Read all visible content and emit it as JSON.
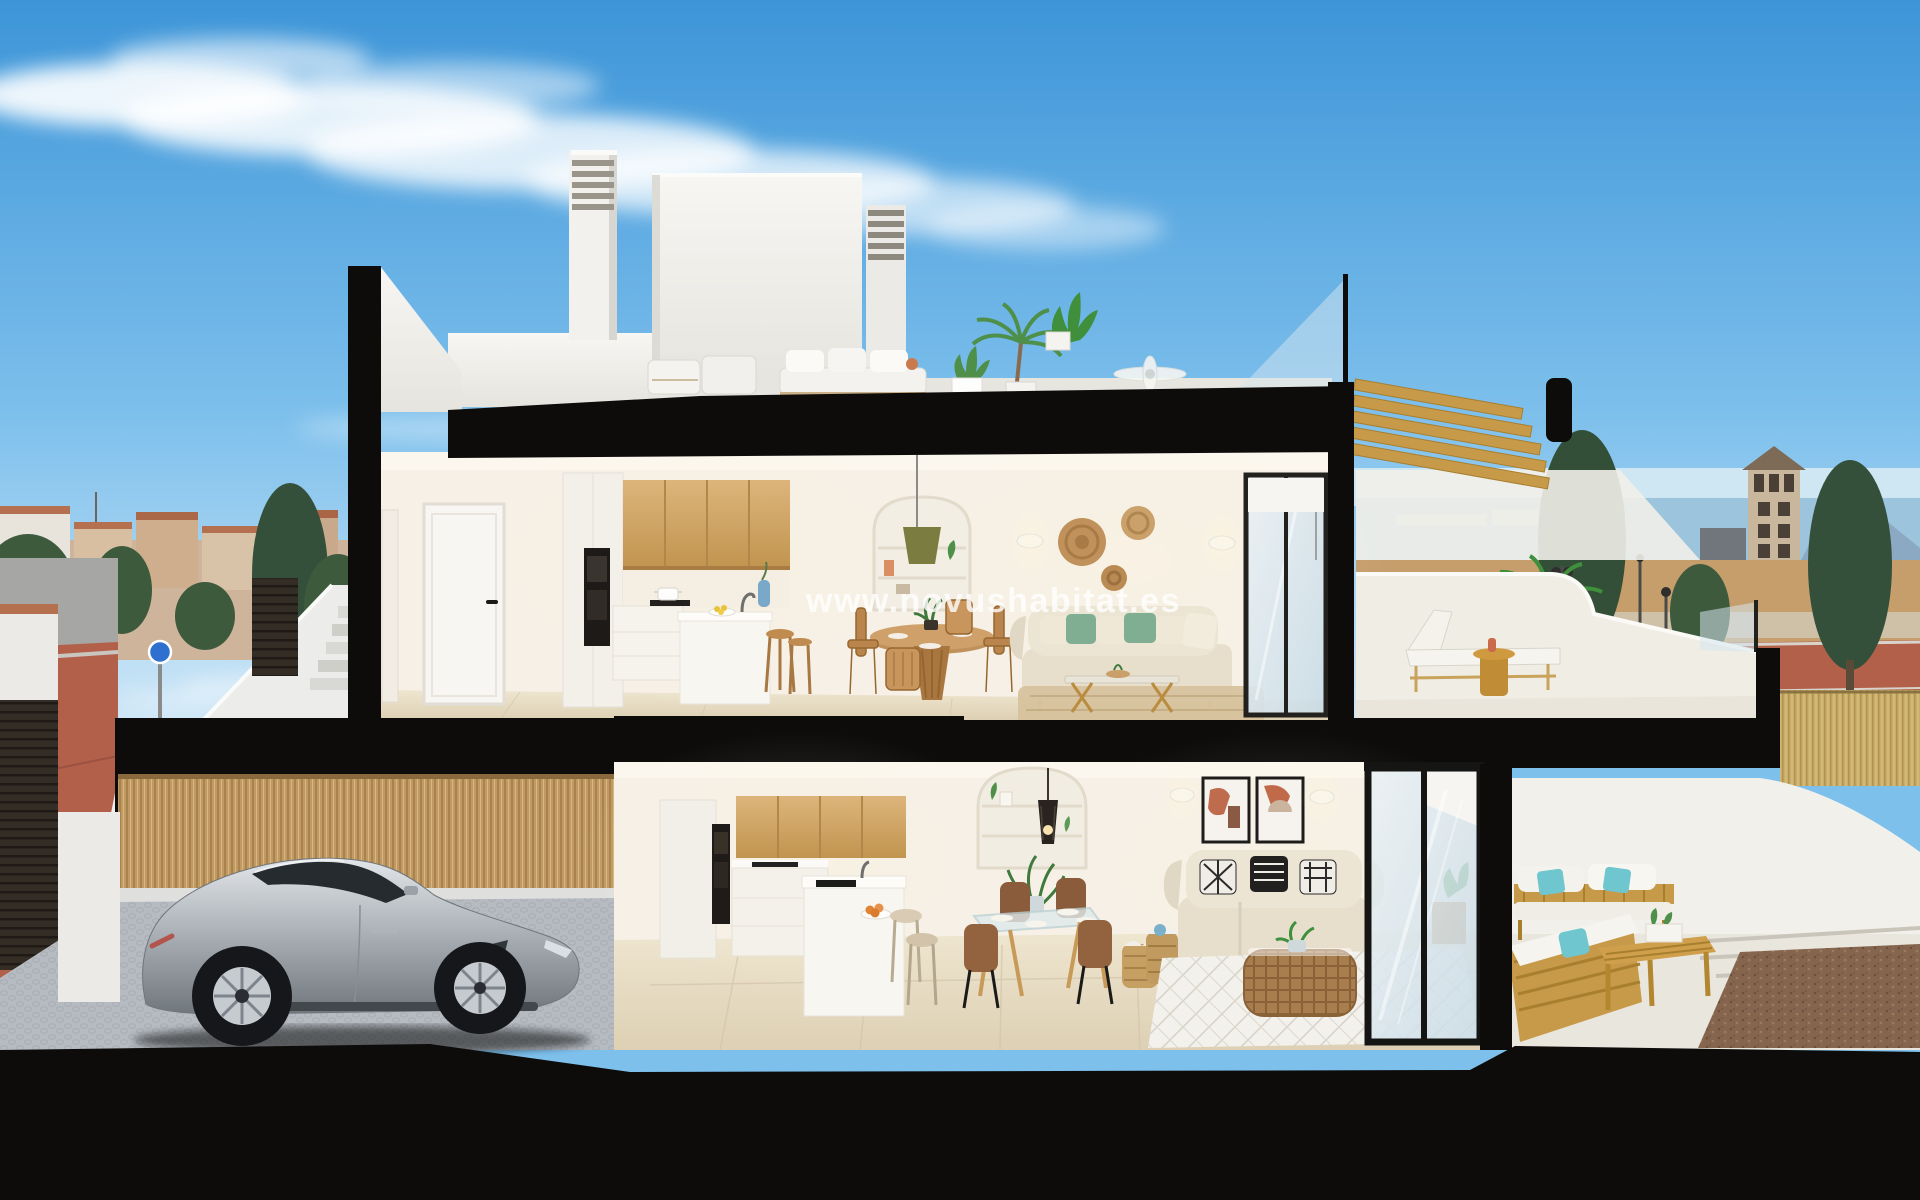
{
  "image": {
    "kind": "photoreal 3d cutaway cross-section render of a two-storey villa",
    "watermark": "www.novushabitat.es"
  },
  "palette": {
    "sky_top": "#3d95d8",
    "sky_mid": "#7ec0ec",
    "sky_horizon": "#d9ecf8",
    "cut_black": "#0d0c0b",
    "wall_white": "#f2f1ee",
    "wall_shade": "#e4e2dc",
    "interior_wall": "#f6f0e6",
    "interior_floor": "#e6dcc4",
    "wood_cabinet": "#d0a566",
    "wood_outdoor": "#c79a4a",
    "sofa_beige": "#e7dfcc",
    "pillow_green": "#7fae93",
    "pillow_teal": "#6fc6cf",
    "rug_jute": "#d7c29d",
    "rug_white": "#f3f1ec",
    "car_silver": "#a8aeb4",
    "car_dark": "#262b30",
    "cobble_gray": "#b6bbc1",
    "fence_bamboo": "#c09a62",
    "reed_fence": "#c9ad69",
    "garage_door": "#332d26",
    "town_wall": "#cdb49a",
    "town_roof": "#b5714f",
    "tree_green": "#3d5a3d",
    "sea_blue": "#9cc4dd",
    "mountain_blue": "#8ba9c2",
    "field_tan": "#c69e6c",
    "road_red": "#b2604a",
    "gravel_brown": "#86654e",
    "tower_tan": "#c8b79c",
    "glass_blue": "#d6e6ef",
    "watermark_white": "#ffffff"
  },
  "scene": {
    "background": [
      "sky",
      "clouds",
      "town-skyline-left",
      "street-left",
      "sea-horizon",
      "watchtower",
      "mountains",
      "dry-field",
      "red-road",
      "cypress-trees",
      "lamp-posts",
      "reed-fence"
    ],
    "house": {
      "roof_terrace": [
        "stair-bulkhead",
        "louvered-chimney-left",
        "louvered-chimney-right",
        "parapet",
        "glass-balustrade",
        "outdoor-sofa",
        "lounge-chairs",
        "potted-palm",
        "ceiling-fan"
      ],
      "upper_floor": [
        "hallway-doors",
        "kitchen-wood-cabinets",
        "built-in-oven",
        "kitchen-island",
        "bar-stools",
        "arched-niche-pendant",
        "round-dining-table",
        "wood-chairs",
        "beige-sofa-green-pillows",
        "wall-baskets",
        "sconces",
        "glass-coffee-table",
        "jute-rug",
        "sliding-glass-door",
        "terrace-pergola",
        "sun-lounger",
        "side-table",
        "potted-palm"
      ],
      "ground_floor": [
        "carport",
        "silver-sports-car",
        "bamboo-fence",
        "slatted-garage-door",
        "cobble-driveway",
        "kitchen-island-sink",
        "oranges-bowl",
        "arched-niche-cage-pendant",
        "glass-dining-table",
        "brown-chairs",
        "beige-sofa-bw-pillows",
        "art-frames",
        "rattan-coffee-table",
        "diamond-rug",
        "sliding-glass-door",
        "outdoor-wood-sofas",
        "teal-pillows",
        "slat-bench",
        "gravel-bed"
      ]
    }
  }
}
